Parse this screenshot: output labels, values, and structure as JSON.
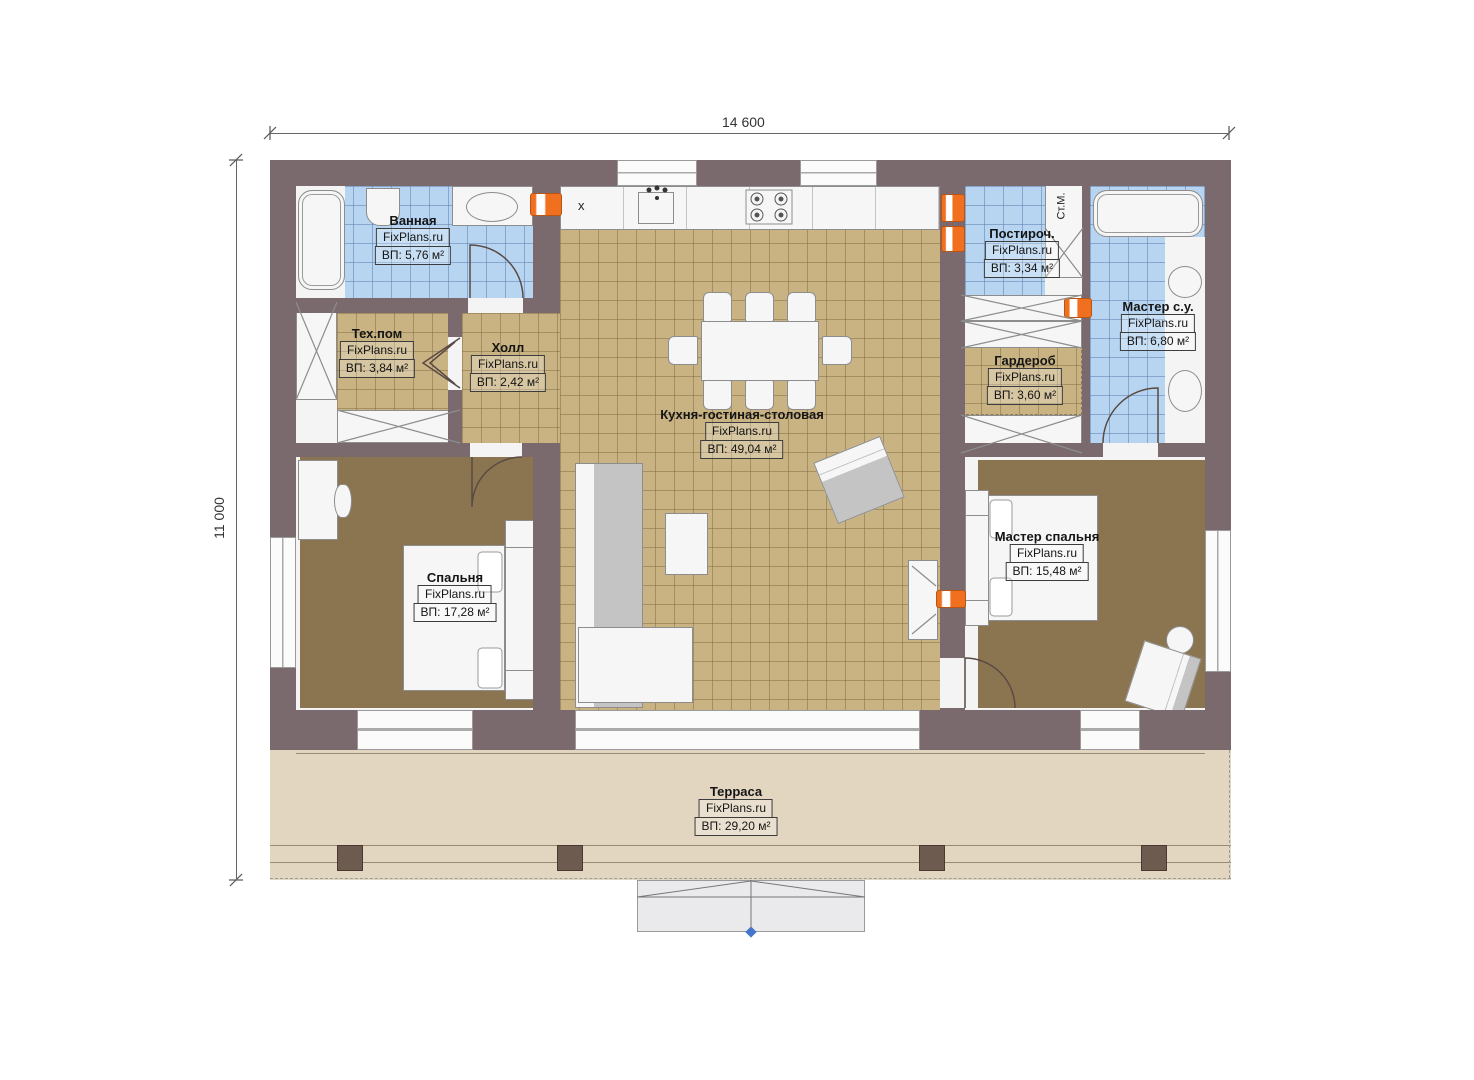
{
  "drawing": {
    "type": "floor-plan",
    "dimensions": {
      "width_label": "14 600",
      "height_label": "11 000"
    },
    "watermark": "FixPlans.ru"
  },
  "rooms": {
    "bathroom": {
      "name": "Ванная",
      "brand": "FixPlans.ru",
      "area": "ВП: 5,76 м²"
    },
    "tech": {
      "name": "Тех.пом",
      "brand": "FixPlans.ru",
      "area": "ВП: 3,84 м²"
    },
    "hall": {
      "name": "Холл",
      "brand": "FixPlans.ru",
      "area": "ВП: 2,42 м²"
    },
    "kitchen": {
      "name": "Кухня-гостиная-столовая",
      "brand": "FixPlans.ru",
      "area": "ВП: 49,04 м²"
    },
    "laundry": {
      "name": "Постироч.",
      "brand": "FixPlans.ru",
      "area": "ВП: 3,34 м²"
    },
    "master_bath": {
      "name": "Мастер с.у.",
      "brand": "FixPlans.ru",
      "area": "ВП: 6,80 м²"
    },
    "wardrobe": {
      "name": "Гардероб",
      "brand": "FixPlans.ru",
      "area": "ВП: 3,60 м²"
    },
    "bedroom": {
      "name": "Спальня",
      "brand": "FixPlans.ru",
      "area": "ВП: 17,28 м²"
    },
    "master_bedroom": {
      "name": "Мастер спальня",
      "brand": "FixPlans.ru",
      "area": "ВП: 15,48 м²"
    },
    "terrace": {
      "name": "Терраса",
      "brand": "FixPlans.ru",
      "area": "ВП: 29,20 м²"
    }
  },
  "annotations": {
    "washing_machine": "Ст.М.",
    "x_marker": "x"
  },
  "colors": {
    "wall": "#7a696d",
    "tile_floor": "#c9b383",
    "wet_tile": "#b7d5f1",
    "carpet": "#8b7450",
    "terrace": "#e3d6c0",
    "accent_orange": "#f07020"
  }
}
